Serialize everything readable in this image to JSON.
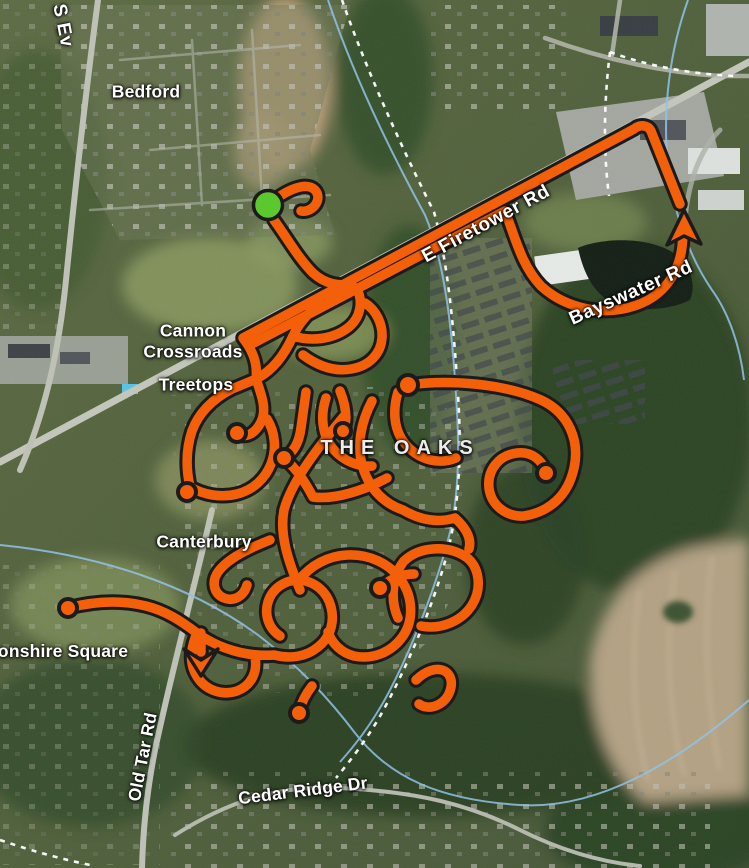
{
  "map": {
    "view": "satellite-activity-map",
    "labels": {
      "street_top_left_partial": "S Ev",
      "bedford": "Bedford",
      "cannon_crossroads": "Cannon Crossroads",
      "treetops": "Treetops",
      "the_oaks": "THE OAKS",
      "canterbury": "Canterbury",
      "devonshire_square_partial": "vonshire Square",
      "e_firetower_rd": "E Firetower Rd",
      "bayswater_rd": "Bayswater Rd",
      "old_tar_rd": "Old Tar Rd",
      "cedar_ridge_dr": "Cedar Ridge Dr"
    },
    "route": {
      "color": "#F4600A",
      "casing_color": "#1B1B1B",
      "start_marker_color": "#5BC92E",
      "start_marker_shape": "circle",
      "end_arrow_direction": "up",
      "mid_arrow_direction": "down"
    },
    "terrain_colors": {
      "forest": "#2C4425",
      "field": "#8B9A60",
      "farmland": "#B4A284",
      "dirt": "#BFA17D",
      "road": "#BEC2B6",
      "creek": "#8FC2E8",
      "trail_dash": "#FFFFFF",
      "lake": "#141F15"
    }
  }
}
